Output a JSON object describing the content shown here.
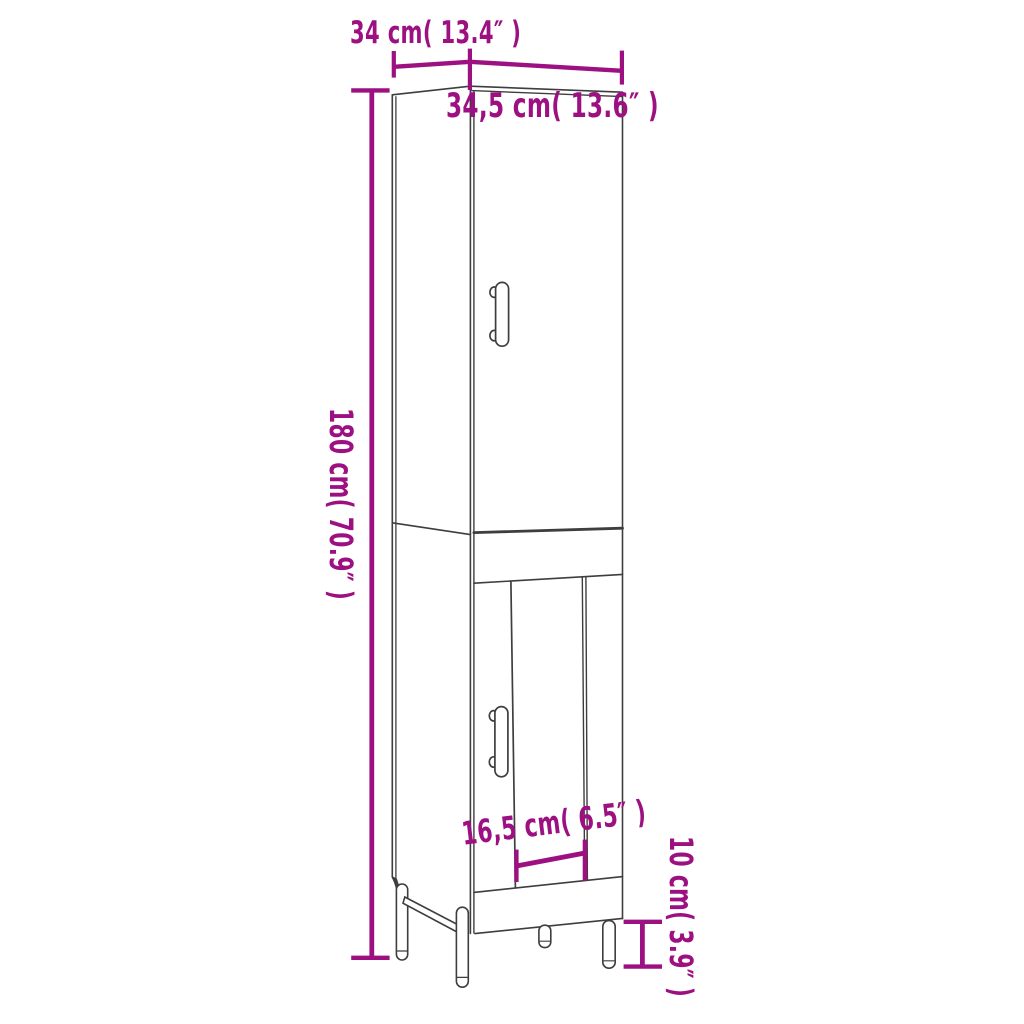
{
  "diagram": {
    "type": "product-dimension-diagram",
    "subject": "tall-cabinet-line-drawing",
    "labels": {
      "width_top": "34 cm( 13.4″  )",
      "depth_top": "34,5 cm( 13.6″  )",
      "height_left": "180 cm( 70.9″  )",
      "opening_width": "16,5 cm( 6.5″  )",
      "leg_height": "10 cm( 3.9″  )"
    }
  },
  "colors": {
    "accent": "#9C1082",
    "line": "#3E3E3E",
    "bg": "#FFFFFF"
  }
}
